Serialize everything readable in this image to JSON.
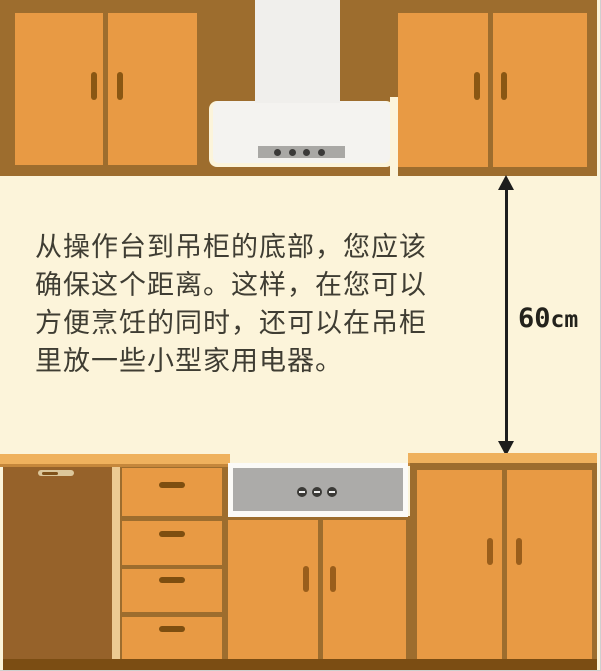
{
  "illustration": {
    "caption_lines": [
      "从操作台到吊柜的底部，您应该",
      "确保这个距离。这样，在您可以",
      "方便烹饪的同时，还可以在吊柜",
      "里放一些小型家用电器。"
    ],
    "measurement": {
      "label": "60cm",
      "value": "60",
      "unit": "cm"
    },
    "icons": {
      "arrow": "double-headed-vertical-arrow",
      "hood_buttons": "four-round-buttons",
      "cooktop_knobs": "three-round-knobs"
    },
    "palette": {
      "background": "#fcf4da",
      "cabinet_frame": "#9d6d2e",
      "cabinet_door": "#e89a44",
      "countertop": "#efb15d",
      "appliance_panel_dark": "#96622a",
      "handle_dark": "#8a5713",
      "hood_white": "#f4f3f0",
      "control_gray": "#acaba9",
      "knob_dark": "#3b3a37",
      "toekick": "#7b4d13",
      "text": "#3f3d33",
      "arrow": "#1d1d1d"
    }
  }
}
